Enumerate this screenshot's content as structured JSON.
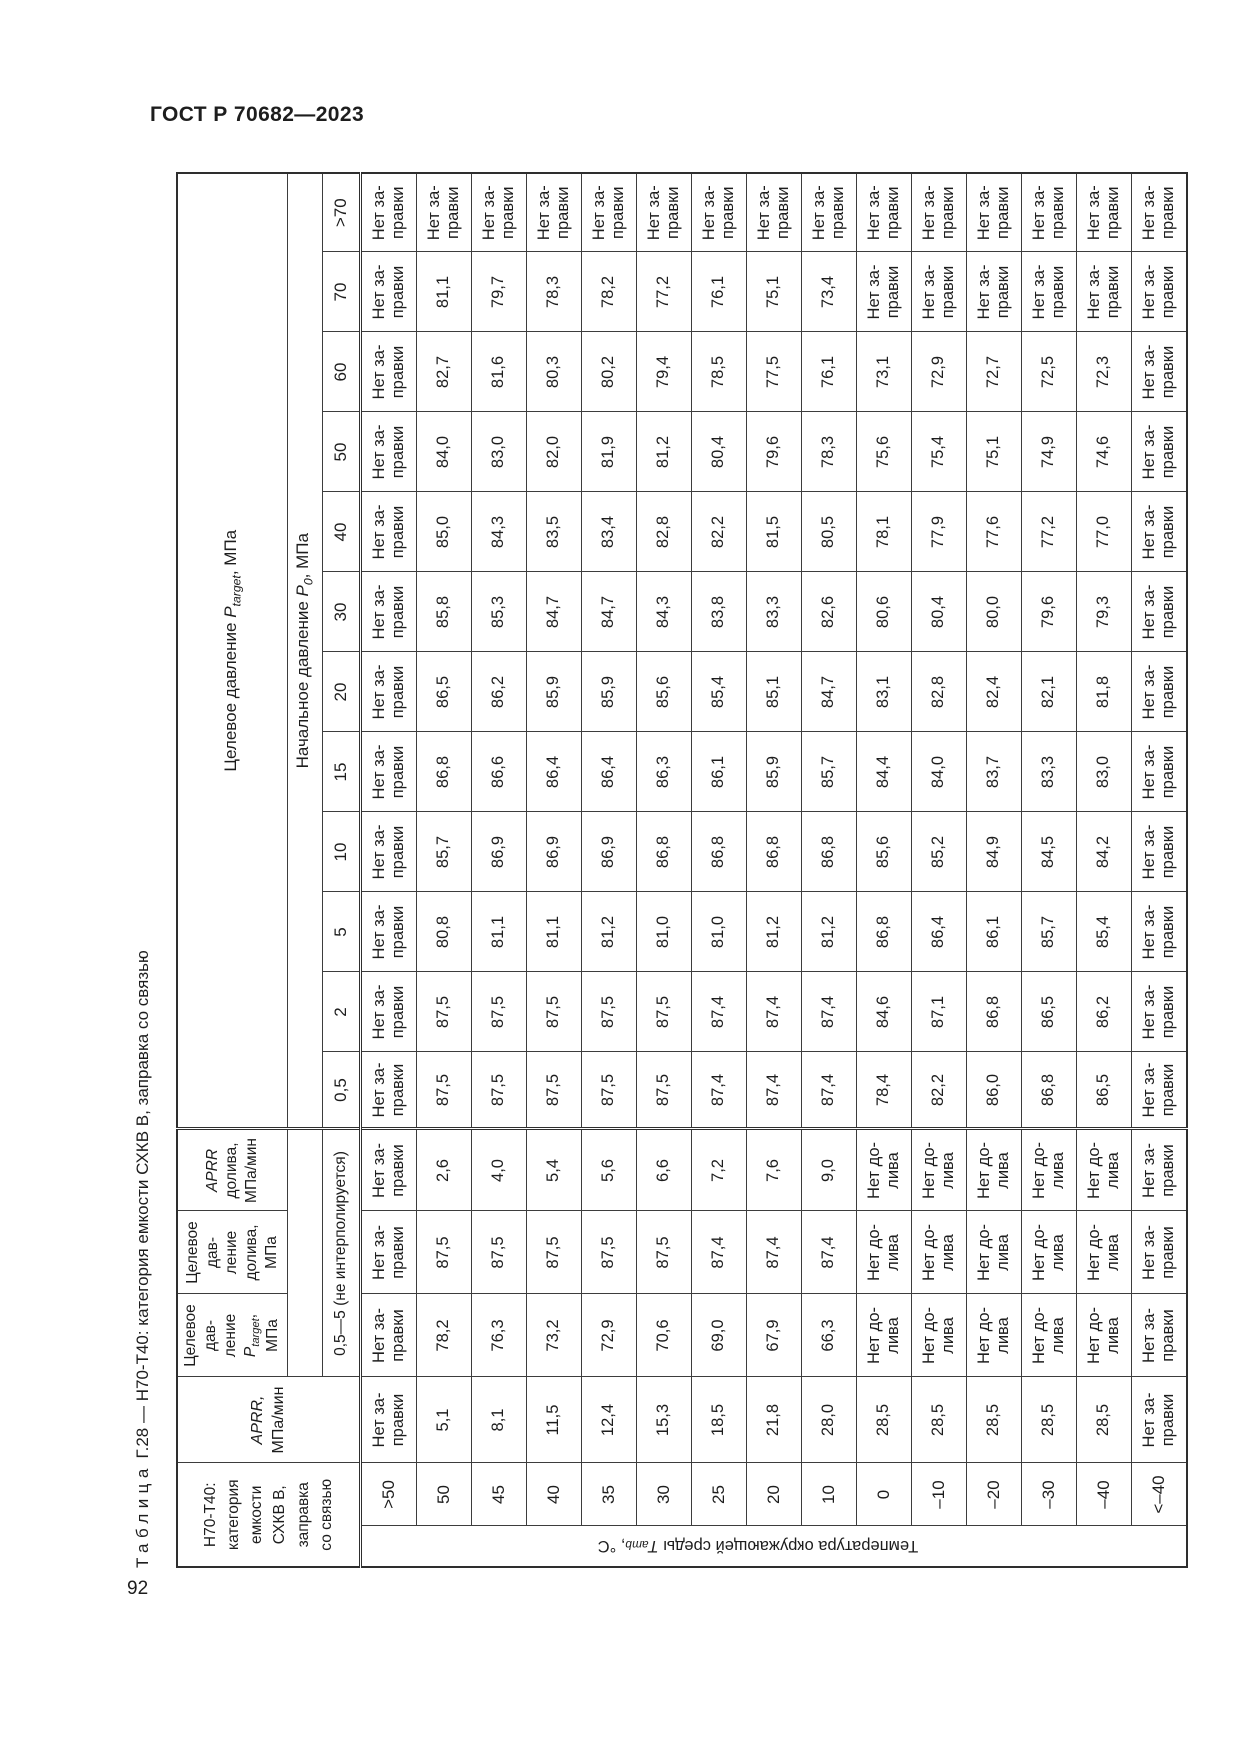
{
  "page": {
    "doc_code": "ГОСТ Р 70682—2023",
    "page_number": "92"
  },
  "caption": {
    "label": "Таблица",
    "number": "Г.28",
    "separator": "—",
    "title": "Н70-Т40: категория емкости СХКВ В, заправка со связью"
  },
  "axis": {
    "pre": "Температура окружающей среды ",
    "sym": "T",
    "sub": "amb",
    "post": ", °C"
  },
  "head": {
    "corner": "Н70-Т40:\nкатегория\nемкости\nСХКВ В,\nзаправка\nсо связью",
    "aprr": {
      "sym": "APRR,",
      "unit": "МПа/мин"
    },
    "ptarget": {
      "lines": "Целевое\nдав-\nление",
      "sym": "P",
      "sub": "target",
      "post": ",",
      "unit": "МПа"
    },
    "pdoliva": {
      "lines": "Целевое\nдав-\nление\nдолива,\nМПа"
    },
    "aprrdoliva": {
      "sym": "APRR",
      "lines": "долива,\nМПа/мин"
    },
    "range_note": "0,5—5 (не интерполируется)",
    "group_target": {
      "pre": "Целевое давление ",
      "sym": "P",
      "sub": "target",
      "post": ", МПа"
    },
    "group_p0": {
      "pre": "Начальное давление ",
      "sym": "P",
      "sub": "0",
      "post": ", МПа"
    },
    "p0_ticks": [
      "0,5",
      "2",
      "5",
      "10",
      "15",
      "20",
      "30",
      "40",
      "50",
      "60",
      "70",
      ">70"
    ]
  },
  "rows": [
    {
      "t": ">50",
      "aprr": "Нет за-\nправки",
      "ptarget": "Нет за-\nправки",
      "pdoliva": "Нет за-\nправки",
      "aprrdoliva": "Нет за-\nправки",
      "p0": [
        "Нет за-\nправки",
        "Нет за-\nправки",
        "Нет за-\nправки",
        "Нет за-\nправки",
        "Нет за-\nправки",
        "Нет за-\nправки",
        "Нет за-\nправки",
        "Нет за-\nправки",
        "Нет за-\nправки",
        "Нет за-\nправки",
        "Нет за-\nправки",
        "Нет за-\nправки"
      ]
    },
    {
      "t": "50",
      "aprr": "5,1",
      "ptarget": "78,2",
      "pdoliva": "87,5",
      "aprrdoliva": "2,6",
      "p0": [
        "87,5",
        "87,5",
        "80,8",
        "85,7",
        "86,8",
        "86,5",
        "85,8",
        "85,0",
        "84,0",
        "82,7",
        "81,1",
        "Нет за-\nправки"
      ]
    },
    {
      "t": "45",
      "aprr": "8,1",
      "ptarget": "76,3",
      "pdoliva": "87,5",
      "aprrdoliva": "4,0",
      "p0": [
        "87,5",
        "87,5",
        "81,1",
        "86,9",
        "86,6",
        "86,2",
        "85,3",
        "84,3",
        "83,0",
        "81,6",
        "79,7",
        "Нет за-\nправки"
      ]
    },
    {
      "t": "40",
      "aprr": "11,5",
      "ptarget": "73,2",
      "pdoliva": "87,5",
      "aprrdoliva": "5,4",
      "p0": [
        "87,5",
        "87,5",
        "81,1",
        "86,9",
        "86,4",
        "85,9",
        "84,7",
        "83,5",
        "82,0",
        "80,3",
        "78,3",
        "Нет за-\nправки"
      ]
    },
    {
      "t": "35",
      "aprr": "12,4",
      "ptarget": "72,9",
      "pdoliva": "87,5",
      "aprrdoliva": "5,6",
      "p0": [
        "87,5",
        "87,5",
        "81,2",
        "86,9",
        "86,4",
        "85,9",
        "84,7",
        "83,4",
        "81,9",
        "80,2",
        "78,2",
        "Нет за-\nправки"
      ]
    },
    {
      "t": "30",
      "aprr": "15,3",
      "ptarget": "70,6",
      "pdoliva": "87,5",
      "aprrdoliva": "6,6",
      "p0": [
        "87,5",
        "87,5",
        "81,0",
        "86,8",
        "86,3",
        "85,6",
        "84,3",
        "82,8",
        "81,2",
        "79,4",
        "77,2",
        "Нет за-\nправки"
      ]
    },
    {
      "t": "25",
      "aprr": "18,5",
      "ptarget": "69,0",
      "pdoliva": "87,4",
      "aprrdoliva": "7,2",
      "p0": [
        "87,4",
        "87,4",
        "81,0",
        "86,8",
        "86,1",
        "85,4",
        "83,8",
        "82,2",
        "80,4",
        "78,5",
        "76,1",
        "Нет за-\nправки"
      ]
    },
    {
      "t": "20",
      "aprr": "21,8",
      "ptarget": "67,9",
      "pdoliva": "87,4",
      "aprrdoliva": "7,6",
      "p0": [
        "87,4",
        "87,4",
        "81,2",
        "86,8",
        "85,9",
        "85,1",
        "83,3",
        "81,5",
        "79,6",
        "77,5",
        "75,1",
        "Нет за-\nправки"
      ]
    },
    {
      "t": "10",
      "aprr": "28,0",
      "ptarget": "66,3",
      "pdoliva": "87,4",
      "aprrdoliva": "9,0",
      "p0": [
        "87,4",
        "87,4",
        "81,2",
        "86,8",
        "85,7",
        "84,7",
        "82,6",
        "80,5",
        "78,3",
        "76,1",
        "73,4",
        "Нет за-\nправки"
      ]
    },
    {
      "t": "0",
      "aprr": "28,5",
      "ptarget": "Нет до-\nлива",
      "pdoliva": "Нет до-\nлива",
      "aprrdoliva": "Нет до-\nлива",
      "p0": [
        "78,4",
        "84,6",
        "86,8",
        "85,6",
        "84,4",
        "83,1",
        "80,6",
        "78,1",
        "75,6",
        "73,1",
        "Нет за-\nправки",
        "Нет за-\nправки"
      ]
    },
    {
      "t": "–10",
      "aprr": "28,5",
      "ptarget": "Нет до-\nлива",
      "pdoliva": "Нет до-\nлива",
      "aprrdoliva": "Нет до-\nлива",
      "p0": [
        "82,2",
        "87,1",
        "86,4",
        "85,2",
        "84,0",
        "82,8",
        "80,4",
        "77,9",
        "75,4",
        "72,9",
        "Нет за-\nправки",
        "Нет за-\nправки"
      ]
    },
    {
      "t": "–20",
      "aprr": "28,5",
      "ptarget": "Нет до-\nлива",
      "pdoliva": "Нет до-\nлива",
      "aprrdoliva": "Нет до-\nлива",
      "p0": [
        "86,0",
        "86,8",
        "86,1",
        "84,9",
        "83,7",
        "82,4",
        "80,0",
        "77,6",
        "75,1",
        "72,7",
        "Нет за-\nправки",
        "Нет за-\nправки"
      ]
    },
    {
      "t": "–30",
      "aprr": "28,5",
      "ptarget": "Нет до-\nлива",
      "pdoliva": "Нет до-\nлива",
      "aprrdoliva": "Нет до-\nлива",
      "p0": [
        "86,8",
        "86,5",
        "85,7",
        "84,5",
        "83,3",
        "82,1",
        "79,6",
        "77,2",
        "74,9",
        "72,5",
        "Нет за-\nправки",
        "Нет за-\nправки"
      ]
    },
    {
      "t": "–40",
      "aprr": "28,5",
      "ptarget": "Нет до-\nлива",
      "pdoliva": "Нет до-\nлива",
      "aprrdoliva": "Нет до-\nлива",
      "p0": [
        "86,5",
        "86,2",
        "85,4",
        "84,2",
        "83,0",
        "81,8",
        "79,3",
        "77,0",
        "74,6",
        "72,3",
        "Нет за-\nправки",
        "Нет за-\nправки"
      ]
    },
    {
      "t": "<–40",
      "aprr": "Нет за-\nправки",
      "ptarget": "Нет за-\nправки",
      "pdoliva": "Нет за-\nправки",
      "aprrdoliva": "Нет за-\nправки",
      "p0": [
        "Нет за-\nправки",
        "Нет за-\nправки",
        "Нет за-\nправки",
        "Нет за-\nправки",
        "Нет за-\nправки",
        "Нет за-\nправки",
        "Нет за-\nправки",
        "Нет за-\nправки",
        "Нет за-\nправки",
        "Нет за-\nправки",
        "Нет за-\nправки",
        "Нет за-\nправки"
      ]
    }
  ]
}
